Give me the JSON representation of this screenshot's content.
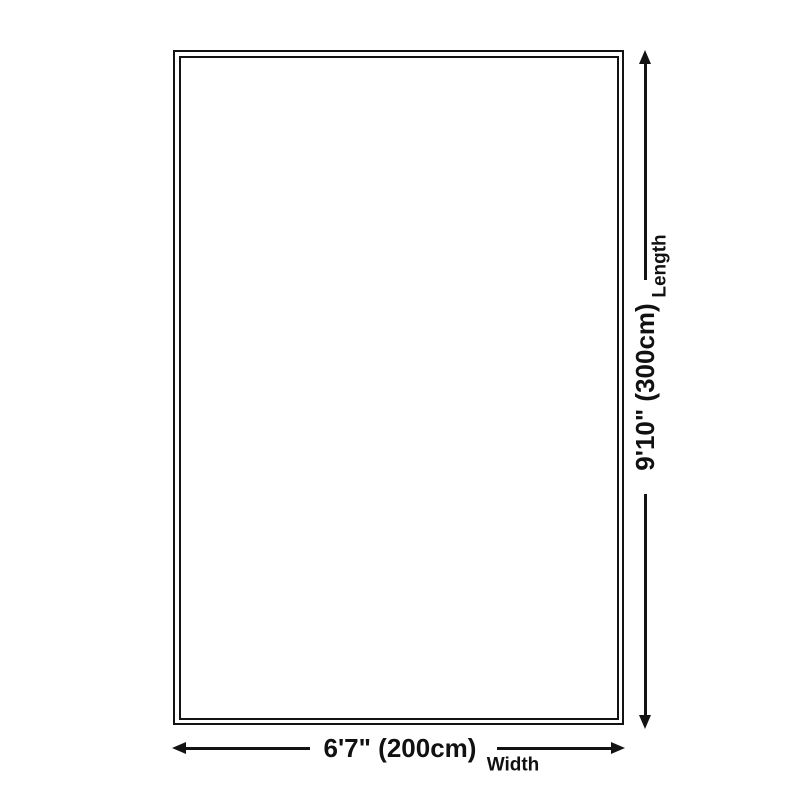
{
  "dimensions": {
    "length": {
      "value": "9'10\" (300cm)",
      "label": "Length"
    },
    "width": {
      "value": "6'7\" (200cm)",
      "label": "Width"
    }
  },
  "icons": {
    "arrow_up": "css-triangle-up",
    "arrow_down": "css-triangle-down",
    "arrow_left": "css-triangle-left",
    "arrow_right": "css-triangle-right"
  },
  "colors": {
    "line": "#131313",
    "text": "#111111",
    "background": "#ffffff"
  }
}
